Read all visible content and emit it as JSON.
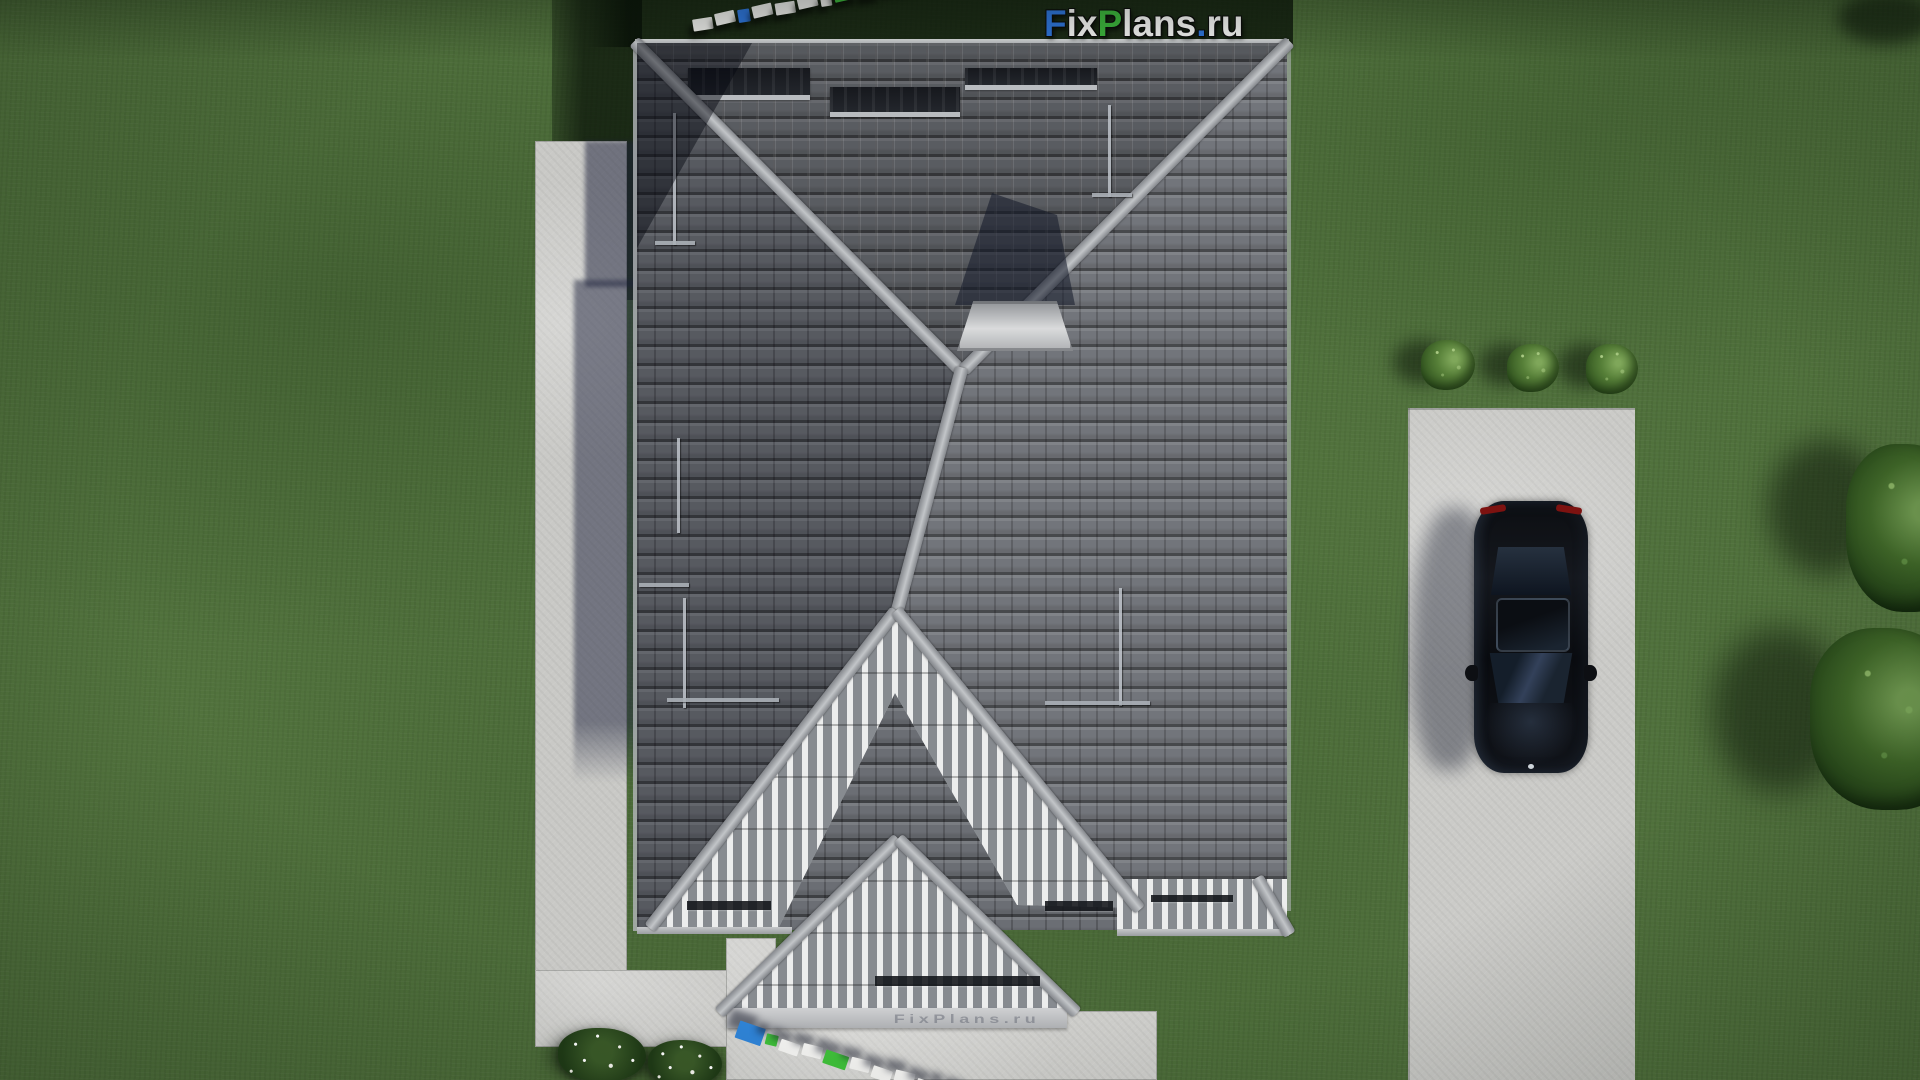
{
  "branding": {
    "logo": {
      "full_text": "FixPlans.ru",
      "segments": [
        {
          "text": "F",
          "color": "#2e74d9"
        },
        {
          "text": "ix",
          "color": "#f3f3f2"
        },
        {
          "text": "P",
          "color": "#3cb43c"
        },
        {
          "text": "lans",
          "color": "#f3f3f2"
        },
        {
          "text": ".",
          "color": "#2e74d9"
        },
        {
          "text": "ru",
          "color": "#f3f3f2"
        }
      ]
    },
    "fascia_watermark": "FixPlans.ru",
    "tiles_top": [
      "#e9e9e7",
      "#e9e9e7",
      "#2e74d9",
      "#e9e9e7",
      "#e9e9e7",
      "#e9e9e7",
      "#e9e9e7",
      "#3cb43c",
      "#e9e9e7",
      "#3cb43c",
      "#2e74d9"
    ],
    "tiles_bottom": [
      "#2f83d6",
      "#3fbf3a",
      "#f2f2f0",
      "#f2f2f0",
      "#3fbf3a",
      "#f2f2f0",
      "#f2f2f0",
      "#f2f2f0",
      "#f2f2f0",
      "#2f83d6",
      "#f2f2f0"
    ]
  },
  "scene": {
    "colors": {
      "lawn": "#50713c",
      "roof_tiles": "#6b6e74",
      "roof_ridge": "#b5b8bb",
      "gable_stripe_light": "#eceded",
      "gable_stripe_dark": "#878b90",
      "concrete_path": "#c9c9c6",
      "driveway": "#cbcbc8",
      "car_body": "#0b0d11",
      "car_taillight": "#7d1210",
      "shrub": "#4a7130",
      "edge_tree": "#2a4a1d",
      "flower": "#ffffff"
    },
    "counts": {
      "driveway_shrubs": 3,
      "flower_shrubs": 2,
      "edge_trees": 2,
      "roof_windows": 3,
      "cars": 1
    }
  }
}
